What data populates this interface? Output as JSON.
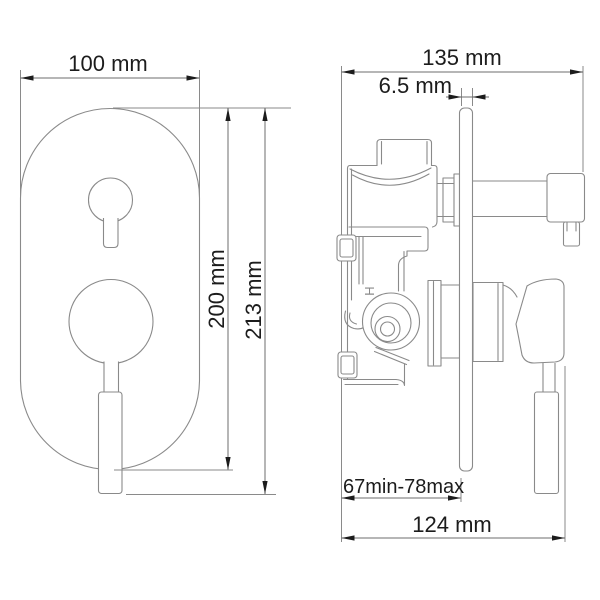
{
  "colors": {
    "outline": "#8a8a8a",
    "dim_line": "#6e6e6e",
    "dim_text": "#1c1c1c",
    "bg": "#ffffff"
  },
  "front_view": {
    "width_dim": "100 mm",
    "plate_height_dim": "200 mm",
    "overall_height_dim": "213 mm"
  },
  "side_view": {
    "depth_dim": "135 mm",
    "plate_thickness_dim": "6.5 mm",
    "mounting_depth_dim": "67min-78max",
    "overall_depth_dim": "124 mm",
    "hot_marking": "H"
  }
}
